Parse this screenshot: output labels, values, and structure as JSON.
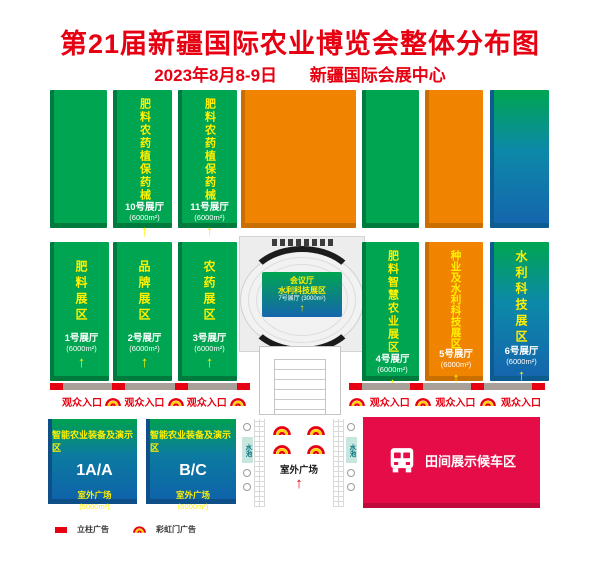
{
  "header": {
    "title": "第21届新疆国际农业博览会整体分布图",
    "subtitle_date": "2023年8月8-9日",
    "subtitle_venue": "新疆国际会展中心"
  },
  "arrow_glyph": "↑",
  "top_row": {
    "hall_10": {
      "area": "肥料农药植保药械",
      "name": "10号展厅",
      "size": "(6000m²)"
    },
    "hall_11": {
      "area": "肥料农药植保药械",
      "name": "11号展厅",
      "size": "(6000m²)"
    }
  },
  "middle_row": {
    "hall_1": {
      "area": "肥料展区",
      "name": "1号展厅",
      "size": "(6000m²)"
    },
    "hall_2": {
      "area": "品牌展区",
      "name": "2号展厅",
      "size": "(6000m²)"
    },
    "hall_3": {
      "area": "农药展区",
      "name": "3号展厅",
      "size": "(6000m²)"
    },
    "hall_4": {
      "area": "肥料智慧农业展区",
      "name": "4号展厅",
      "size": "(6000m²)"
    },
    "hall_5": {
      "area": "种业及水利科技展区",
      "name": "5号展厅",
      "size": "(6000m²)"
    },
    "hall_6": {
      "area": "水利科技展区",
      "name": "6号展厅",
      "size": "(6000m²)"
    }
  },
  "center_building": {
    "sign_line1": "会议厅",
    "sign_line2": "水利科技展区",
    "sign_hall": "7号展厅",
    "sign_size": "(3000m²)"
  },
  "entrance": {
    "label": "观众入口"
  },
  "bottom": {
    "outdoor_blocks": [
      {
        "title": "智能农业装备及演示区",
        "code": "1A/A",
        "sub": "室外广场",
        "size": "(5000m²)"
      },
      {
        "title": "智能农业装备及演示区",
        "code": "B/C",
        "sub": "室外广场",
        "size": "(5000m²)"
      }
    ],
    "plaza": {
      "water_label": "水池",
      "label": "室外广场"
    },
    "bus_area": {
      "label": "田间展示候车区"
    }
  },
  "legend": {
    "pillar_label": "立柱广告",
    "rainbow_label": "彩虹门广告"
  },
  "icons": {
    "rainbow_gate": "rainbow-gate-icon",
    "bus": "bus-icon",
    "pillar_ad": "pillar-ad-marker"
  },
  "colors": {
    "red": "#E60012",
    "green": "#00A551",
    "orange": "#F08300",
    "blue": "#1566AD",
    "crimson": "#E60C48",
    "yellow": "#FFF000",
    "strip_gray": "#A89F98"
  }
}
